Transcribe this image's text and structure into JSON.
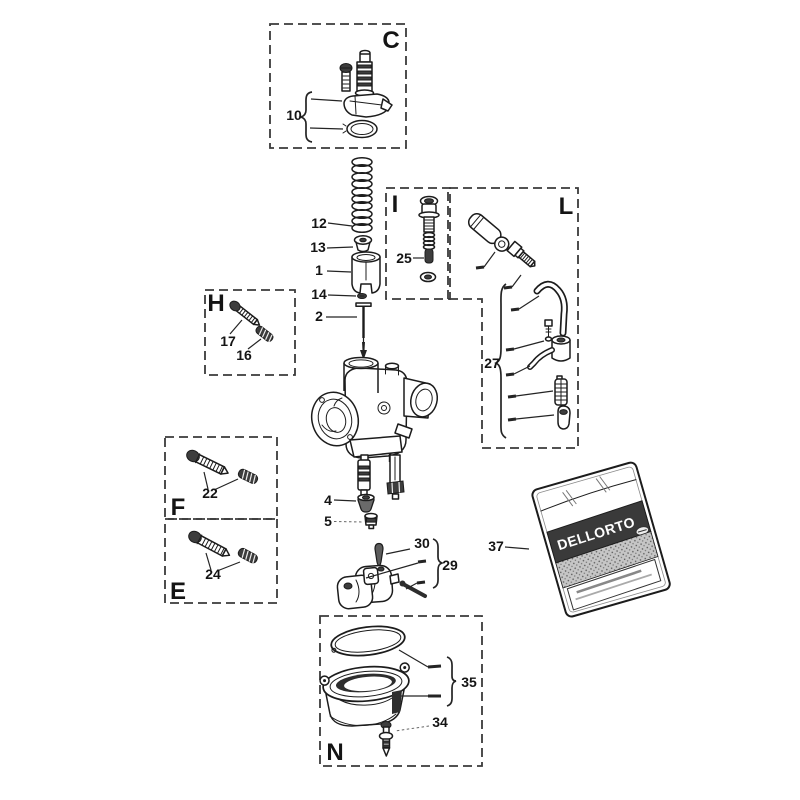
{
  "diagram": {
    "type": "exploded-parts-diagram",
    "subject": "carburetor parts",
    "colors": {
      "background": "#ffffff",
      "ink": "#1c1c1c",
      "box_dash": "#3a3a3a",
      "dark_fill": "#3d3d3d",
      "bag_band": "#3a3a3a"
    },
    "sections": {
      "c": "C",
      "i": "I",
      "l": "L",
      "h": "H",
      "f": "F",
      "e": "E",
      "n": "N"
    },
    "parts": {
      "p1": "1",
      "p2": "2",
      "p4": "4",
      "p5": "5",
      "p10": "10",
      "p12": "12",
      "p13": "13",
      "p14": "14",
      "p16": "16",
      "p17": "17",
      "p22": "22",
      "p24": "24",
      "p25": "25",
      "p27": "27",
      "p29": "29",
      "p30": "30",
      "p34": "34",
      "p35": "35",
      "p37": "37"
    },
    "bag": {
      "brand": "DELLORTO"
    }
  }
}
